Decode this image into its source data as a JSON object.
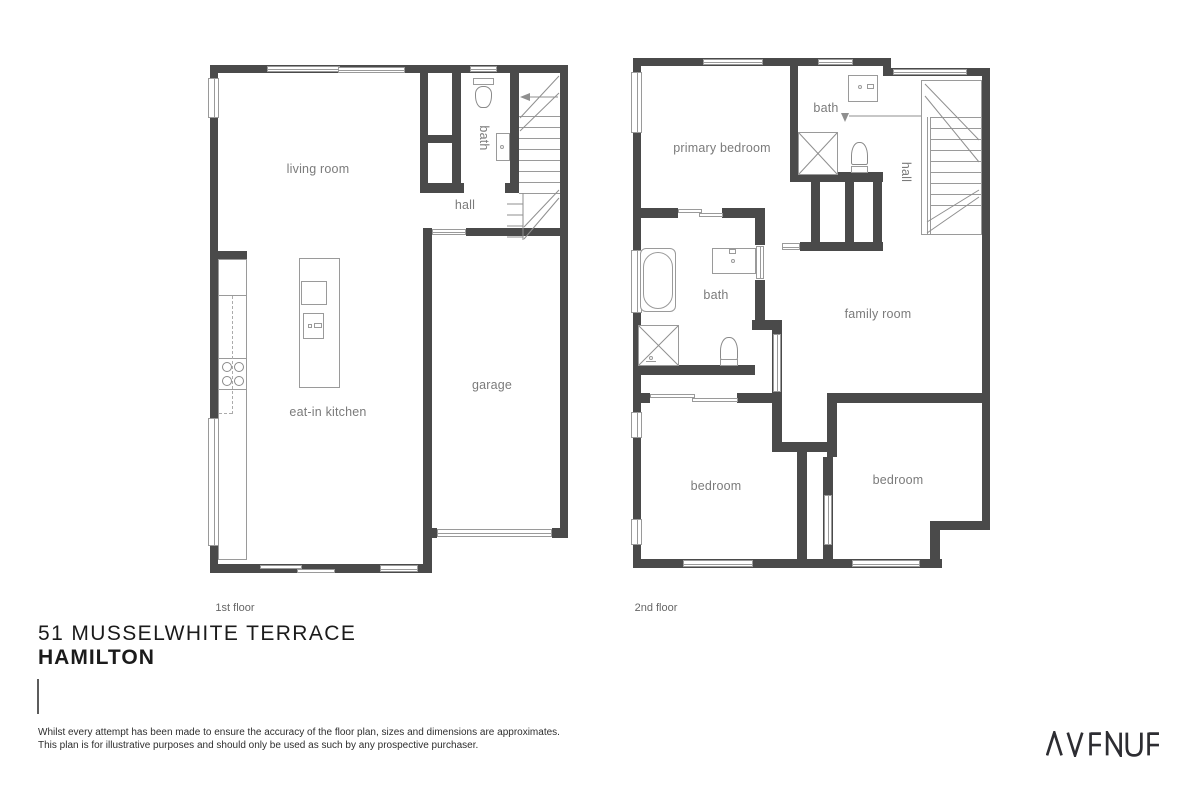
{
  "plans": {
    "floor1": {
      "floor_label": "1st floor",
      "rooms": {
        "living_room": "living room",
        "bath": "bath",
        "hall": "hall",
        "eat_in_kitchen": "eat-in kitchen",
        "garage": "garage"
      }
    },
    "floor2": {
      "floor_label": "2nd floor",
      "rooms": {
        "primary_bedroom": "primary bedroom",
        "bath_ensuite": "bath",
        "hall": "hall",
        "bath_main": "bath",
        "family_room": "family room",
        "bedroom_left": "bedroom",
        "bedroom_right": "bedroom"
      }
    }
  },
  "address": {
    "line1": "51 MUSSELWHITE TERRACE",
    "line2": "HAMILTON"
  },
  "disclaimer": {
    "line1": "Whilst every attempt has been made to ensure the accuracy of the floor plan, sizes and dimensions are approximates.",
    "line2": "This plan is for illustrative purposes and should only be used as such by any prospective purchaser."
  },
  "branding": {
    "logo_text": "AVENUE"
  },
  "colors": {
    "wall": "#4a4a4a",
    "line": "#9a9a9a",
    "label": "#7b7b7b",
    "title": "#1b1b1b",
    "logo": "#2d2d32"
  }
}
